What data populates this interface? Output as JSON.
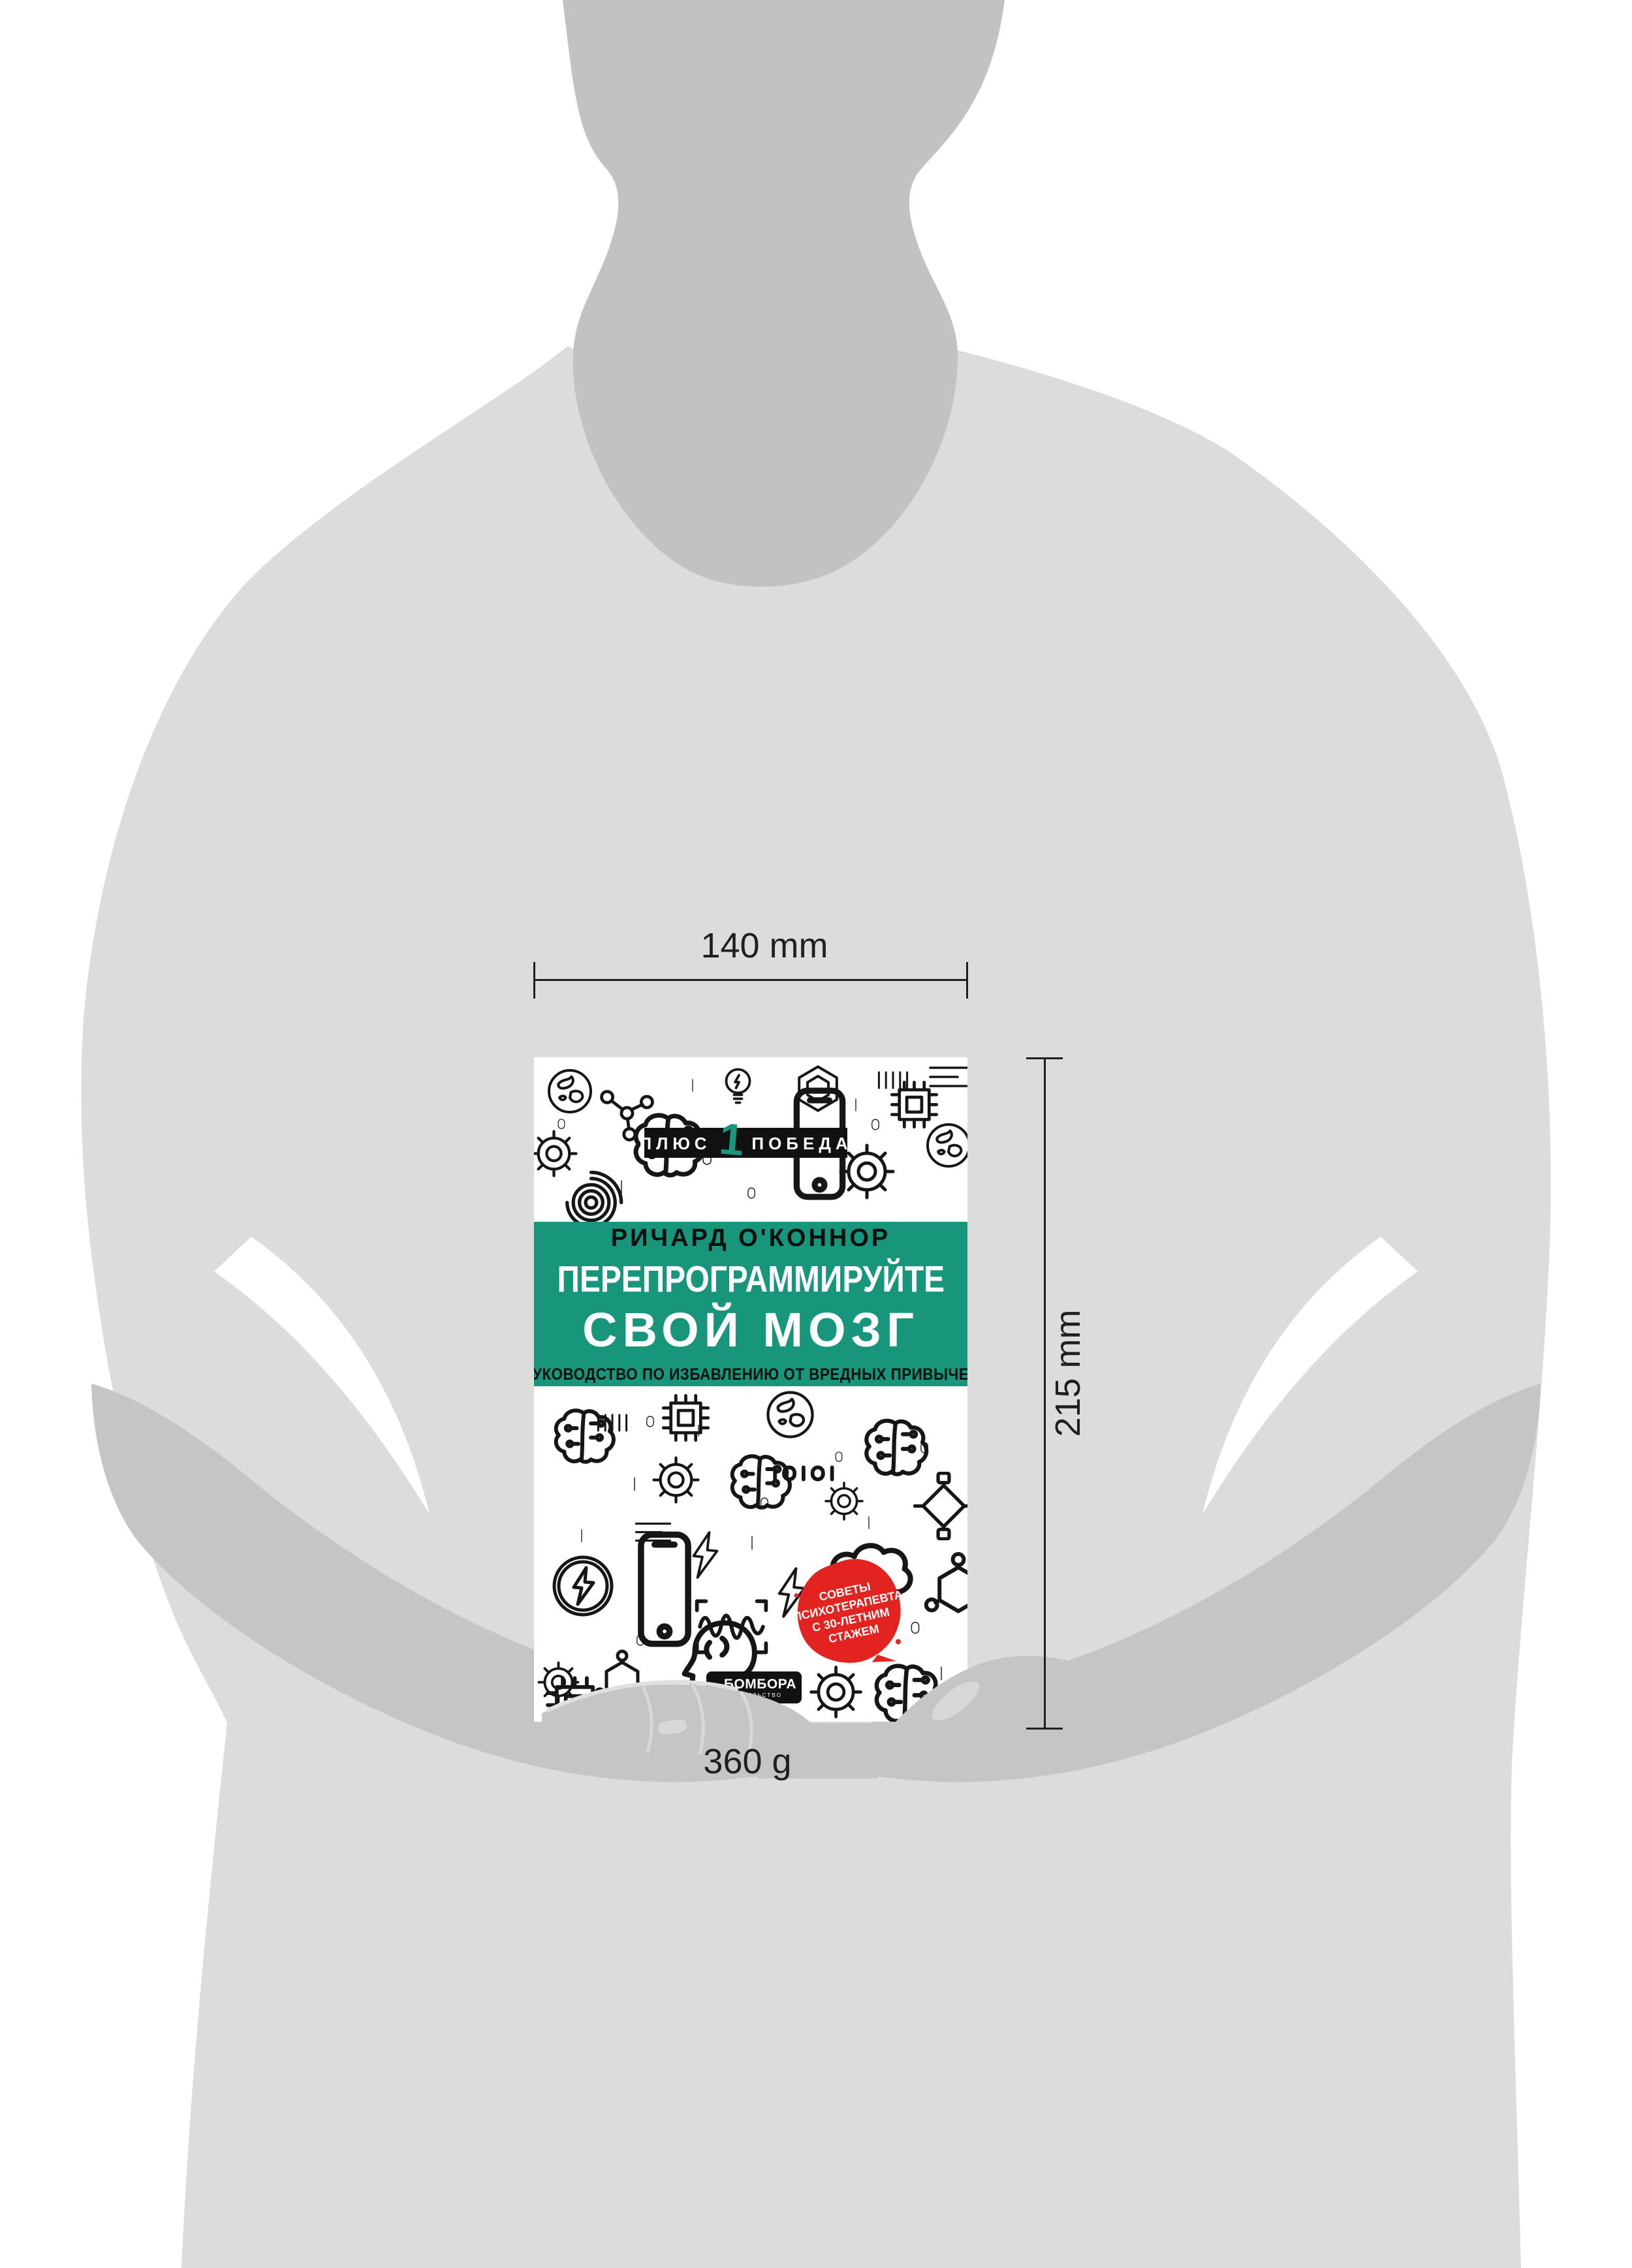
{
  "product_shot": {
    "width_label": "140 mm",
    "height_label": "215 mm",
    "weight_label": "360 g"
  },
  "book_cover": {
    "series_badge": {
      "word_left": "ПЛЮС",
      "numeral": "1",
      "word_right": "ПОБЕДА"
    },
    "author": "РИЧАРД О'КОННОР",
    "title_line_1": "ПЕРЕПРОГРАММИРУЙТЕ",
    "title_line_2": "СВОЙ МОЗГ",
    "subtitle": "РУКОВОДСТВО ПО ИЗБАВЛЕНИЮ ОТ ВРЕДНЫХ ПРИВЫЧЕК",
    "sticker": {
      "line_1": "СОВЕТЫ",
      "line_2": "ПСИХОТЕРАПЕВТА",
      "line_3": "С 30-ЛЕТНИМ",
      "line_4": "СТАЖЕМ"
    },
    "publisher": {
      "name": "БОМБОРА",
      "type": "ИЗДАТЕЛЬСТВО"
    }
  },
  "colors": {
    "teal": "#17967C",
    "red": "#E2231F",
    "badge_black": "#111111",
    "ink": "#161616",
    "body_gray": "#DCDCDB",
    "shade_gray": "#C5C5C3",
    "background": "#FFFFFF"
  }
}
